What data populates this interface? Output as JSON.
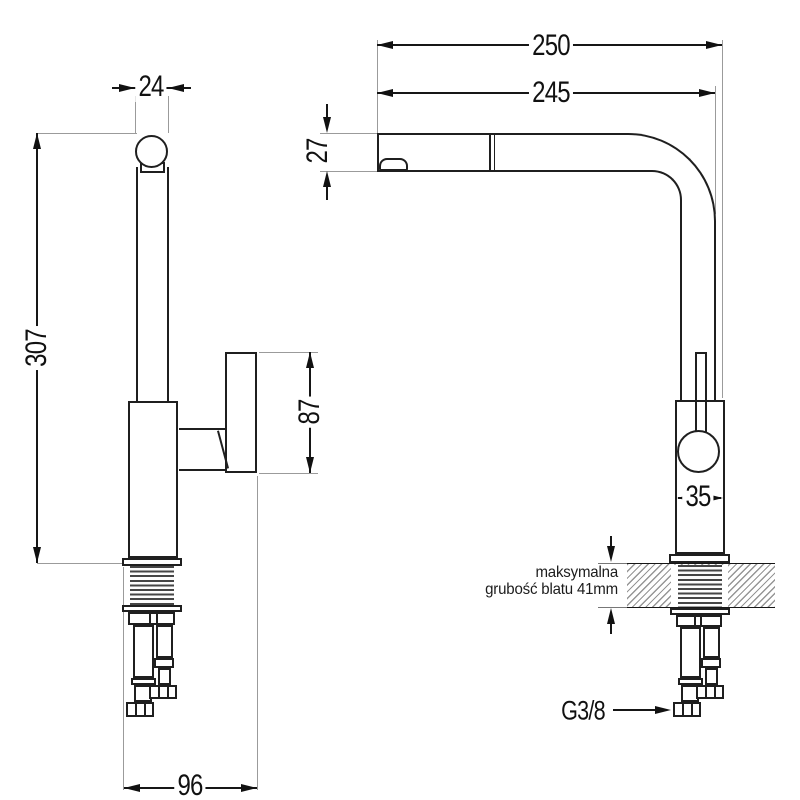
{
  "front_view": {
    "spout_width_mm": "24",
    "total_height_mm": "307",
    "handle_length_mm": "87",
    "base_depth_mm": "96"
  },
  "side_view": {
    "total_reach_mm": "250",
    "spout_reach_mm": "245",
    "spout_tip_height_mm": "27",
    "body_width_mm": "35",
    "counter_note": {
      "line1": "maksymalna",
      "line2": "grubość blatu 41mm"
    },
    "hose_thread_label": "G3/8"
  },
  "colors": {
    "background": "#ffffff",
    "object_line": "#1f1f1f",
    "dimension_line": "#161616",
    "extension_line": "#9b9b9b",
    "hatch_line": "#969696",
    "thread_dark": "#454545"
  }
}
